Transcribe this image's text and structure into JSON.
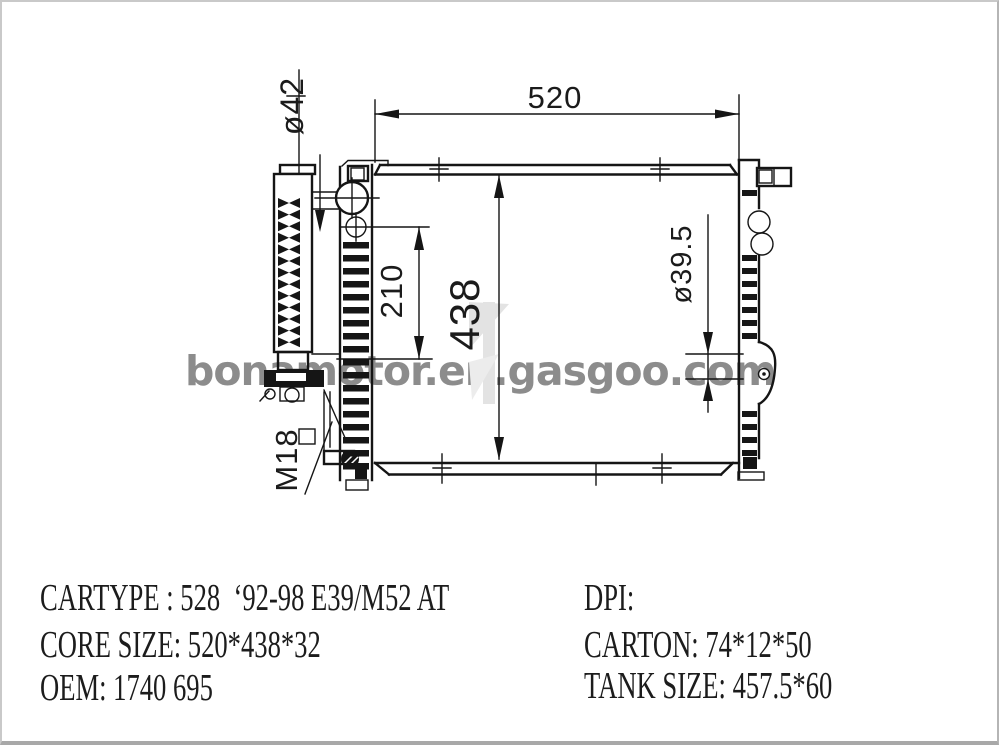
{
  "watermark": {
    "text": "bonamotor.en.gasgoo.com",
    "color": "#8c8c8c"
  },
  "drawing": {
    "dim_core_width": "520",
    "dim_core_height": "438",
    "dim_pitch": "210",
    "dim_inlet_port": "ø42",
    "dim_outlet_port": "ø39.5",
    "dim_drain_thread": "M18"
  },
  "specs": {
    "left": [
      "CARTYPE : 528  ‘92-98 E39/M52 AT",
      "CORE SIZE: 520*438*32",
      "OEM: 1740 695"
    ],
    "right": [
      "DPI:",
      "CARTON: 74*12*50",
      "TANK SIZE: 457.5*60"
    ]
  },
  "colors": {
    "line": "#151515",
    "watermark_gray": "#8c8c8c",
    "faint_logo": "#e3e3e3"
  }
}
